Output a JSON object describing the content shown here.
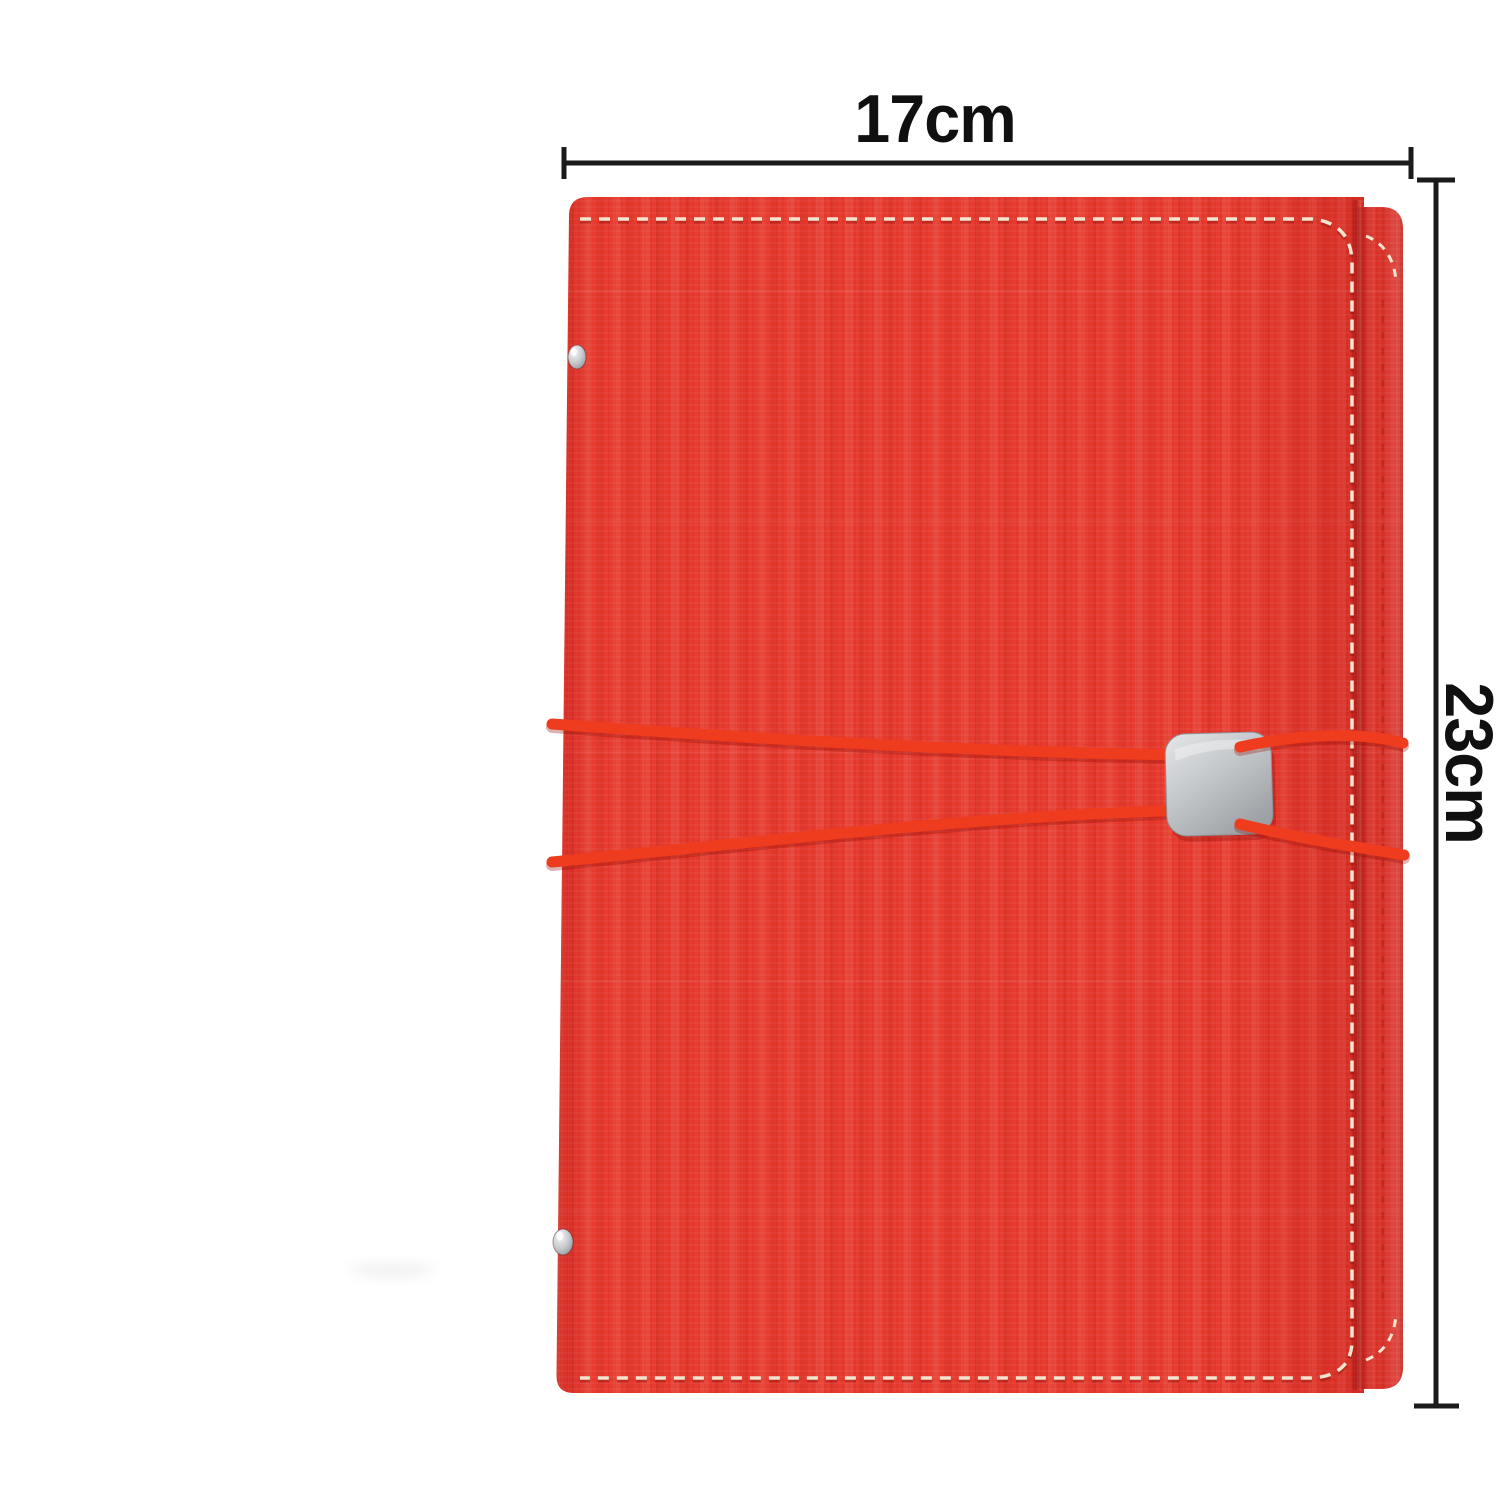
{
  "scene": {
    "type": "product-photo",
    "subject": "Red textured faux-leather notebook cover with elastic cord closure, square metal clasp, snap rivets and stitched edges, annotated with size dimensions",
    "background_color": "#ffffff"
  },
  "annotations": {
    "width_label": "17cm",
    "height_label": "23cm"
  },
  "colors": {
    "cover_red": "#e73b30",
    "flap_red": "#dd342b",
    "cord_red": "#ef3c1e",
    "stitch_cream": "#f2e4cf",
    "clasp_silver_light": "#dfe1e4",
    "clasp_silver_dark": "#a4a8ac",
    "rivet_silver": "#c9ccd0",
    "dimension_line": "#1b1b1b",
    "label_text": "#101010"
  }
}
